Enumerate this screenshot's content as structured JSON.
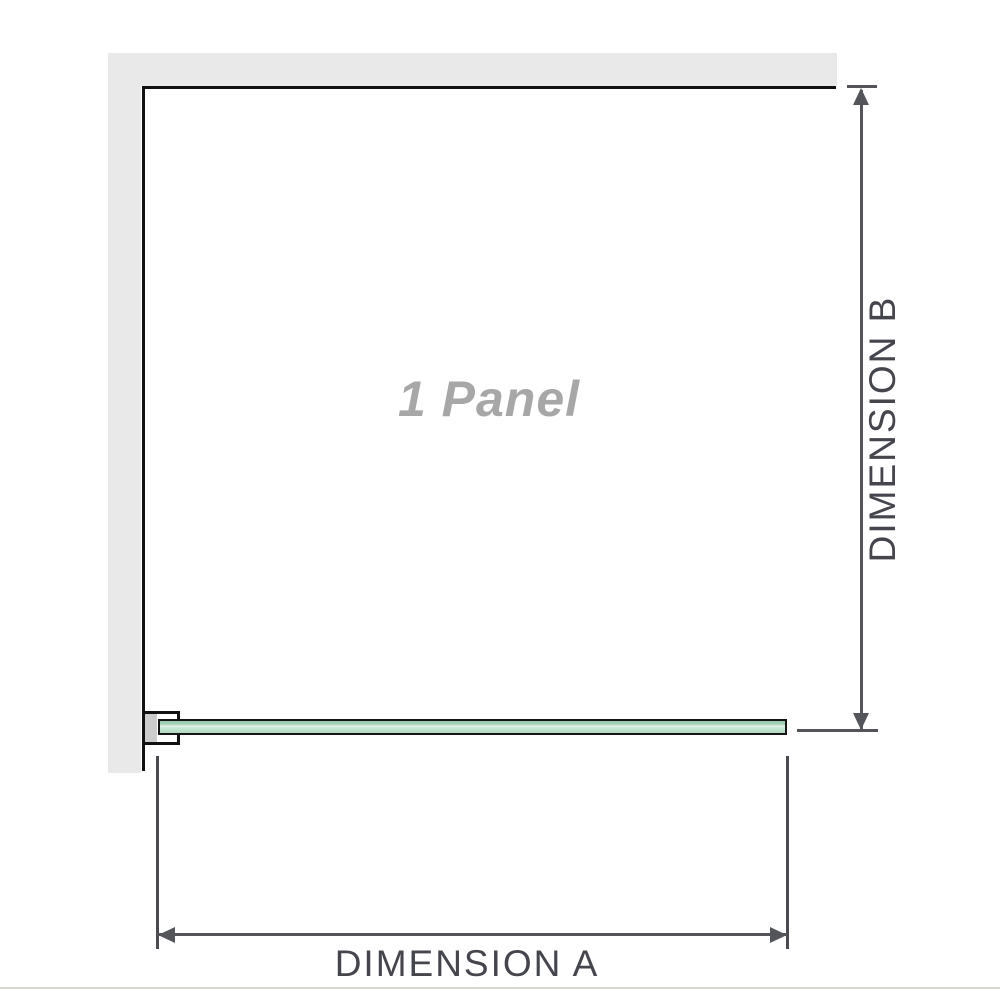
{
  "diagram": {
    "title": "1 Panel shower screen dimension diagram",
    "panel_label": "1 Panel",
    "dimension_a_label": "DIMENSION A",
    "dimension_b_label": "DIMENSION B"
  },
  "colors": {
    "wall": "#e9e9e9",
    "panel_outline": "#111111",
    "dimension_lines": "#54555a",
    "dimension_text": "#45464d",
    "panel_watermark_text": "#a7a7a7",
    "glass_green_top": "#93c8a9",
    "glass_green_highlight": "#e4f3e9",
    "glass_green_bottom": "#aed8bf",
    "bracket_pad": "#cccccc",
    "baseline_rule": "#d9d9d1"
  }
}
